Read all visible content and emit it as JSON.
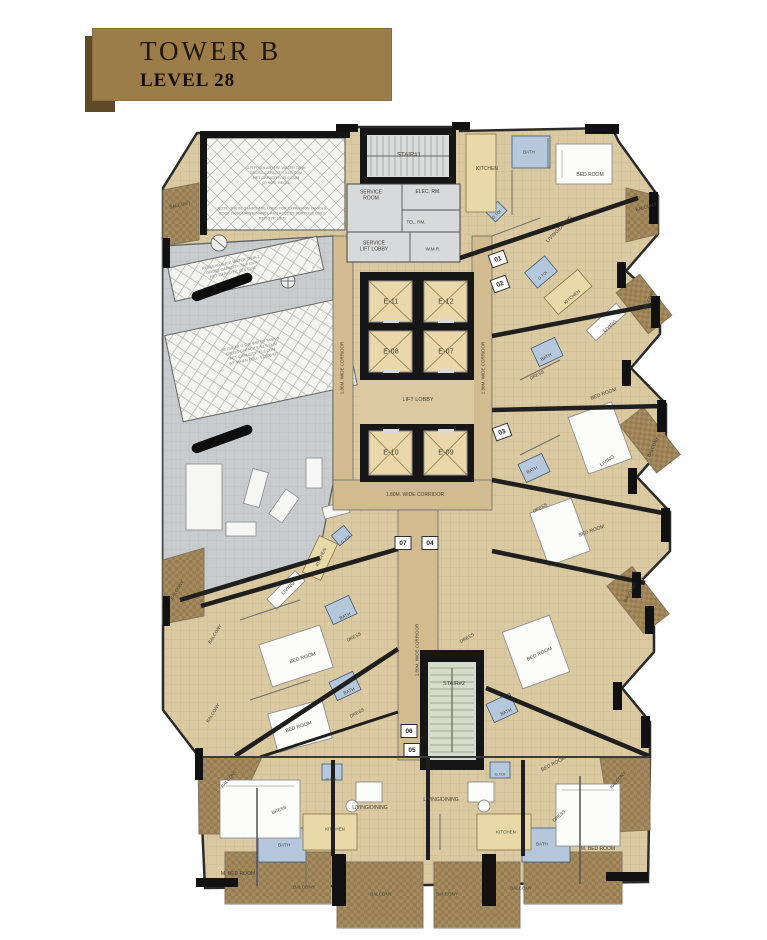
{
  "title": {
    "tower": "TOWER B",
    "level": "LEVEL 28"
  },
  "colors": {
    "banner": "#9c7d4a",
    "banner_shadow": "#5e4a26",
    "floor_tan": "#dbc9a1",
    "corridor_tan": "#d2bc8f",
    "wall_dark": "#161616",
    "mech_gray": "#c9ccce",
    "tank_hatch": "#f4f4f1",
    "balcony_brown": "#a78c60",
    "bath_blue": "#b5c7db",
    "stair_green": "#d5dcc9",
    "lift_cab": "#ead8ab"
  },
  "floor_plan": {
    "elevators": [
      {
        "id": "E-11",
        "x": 391,
        "y": 302
      },
      {
        "id": "E-12",
        "x": 446,
        "y": 302
      },
      {
        "id": "E-08",
        "x": 391,
        "y": 352
      },
      {
        "id": "E-07",
        "x": 446,
        "y": 352
      },
      {
        "id": "E-10",
        "x": 391,
        "y": 453
      },
      {
        "id": "E-09",
        "x": 446,
        "y": 453
      }
    ],
    "unit_badges": [
      {
        "n": "01",
        "x": 498,
        "y": 259,
        "r": -20
      },
      {
        "n": "02",
        "x": 500,
        "y": 284,
        "r": -20
      },
      {
        "n": "03",
        "x": 502,
        "y": 432,
        "r": -20
      },
      {
        "n": "07",
        "x": 403,
        "y": 543,
        "r": 0
      },
      {
        "n": "04",
        "x": 430,
        "y": 543,
        "r": 0
      },
      {
        "n": "06",
        "x": 409,
        "y": 731,
        "r": 0
      },
      {
        "n": "05",
        "x": 412,
        "y": 750,
        "r": 0
      }
    ],
    "labels": [
      {
        "t": "STAIR#1",
        "x": 409,
        "y": 156,
        "s": 6,
        "key": "stair1-label"
      },
      {
        "t": "SERVICE\nROOM",
        "x": 371,
        "y": 196,
        "s": 5,
        "key": "service-room-label"
      },
      {
        "t": "ELEC. RM.",
        "x": 428,
        "y": 193,
        "s": 5,
        "key": "elec-room-label"
      },
      {
        "t": "TEL. RM.",
        "x": 416,
        "y": 222,
        "s": 4.5,
        "key": "tel-room-label"
      },
      {
        "t": "SERVICE\nLIFT LOBBY",
        "x": 374,
        "y": 247,
        "s": 5,
        "key": "service-lift-lobby-label"
      },
      {
        "t": "W.M.R.",
        "x": 433,
        "y": 249,
        "s": 4.5,
        "key": "wmr-label"
      },
      {
        "t": "LIFT LOBBY",
        "x": 418,
        "y": 400,
        "s": 5.5,
        "key": "lift-lobby-label"
      },
      {
        "t": "1.80M. WIDE CORRIDOR",
        "x": 415,
        "y": 496,
        "s": 5,
        "key": "corridor-label-bottom"
      },
      {
        "t": "1.80M. WIDE CORRIDOR",
        "x": 342,
        "y": 368,
        "r": -90,
        "s": 4.5,
        "key": "corridor-label-left"
      },
      {
        "t": "1.80M. WIDE CORRIDOR",
        "x": 483,
        "y": 368,
        "r": -90,
        "s": 4.5,
        "key": "corridor-label-right"
      },
      {
        "t": "1.80M. WIDE CORRIDOR",
        "x": 417,
        "y": 650,
        "r": -90,
        "s": 4.5,
        "key": "corridor-label-mid"
      },
      {
        "t": "STAIR#2",
        "x": 454,
        "y": 684,
        "s": 5.5,
        "key": "stair2-label"
      },
      {
        "t": "KITCHEN",
        "x": 487,
        "y": 170,
        "s": 5
      },
      {
        "t": "BATH",
        "x": 529,
        "y": 152,
        "s": 4.5
      },
      {
        "t": "BED ROOM",
        "x": 590,
        "y": 176,
        "s": 5
      },
      {
        "t": "BALCONY",
        "x": 646,
        "y": 207,
        "r": -15,
        "s": 4.5
      },
      {
        "t": "LIVING/DINING",
        "x": 560,
        "y": 230,
        "r": -46,
        "s": 5
      },
      {
        "t": "G.TOI",
        "x": 497,
        "y": 215,
        "r": -45,
        "s": 4
      },
      {
        "t": "G.TOI",
        "x": 543,
        "y": 276,
        "r": -40,
        "s": 4
      },
      {
        "t": "KITCHEN",
        "x": 572,
        "y": 297,
        "r": -40,
        "s": 4.5
      },
      {
        "t": "LIVING",
        "x": 611,
        "y": 327,
        "r": -42,
        "s": 5
      },
      {
        "t": "BATH",
        "x": 546,
        "y": 357,
        "r": -28,
        "s": 4.5
      },
      {
        "t": "DRESS",
        "x": 537,
        "y": 375,
        "r": -28,
        "s": 4.5
      },
      {
        "t": "BED ROOM",
        "x": 604,
        "y": 395,
        "r": -20,
        "s": 5
      },
      {
        "t": "BALCONY",
        "x": 649,
        "y": 300,
        "r": -65,
        "s": 4.5
      },
      {
        "t": "BATH",
        "x": 532,
        "y": 470,
        "r": -25,
        "s": 4.5
      },
      {
        "t": "LIVING",
        "x": 608,
        "y": 462,
        "r": -35,
        "s": 5
      },
      {
        "t": "DRESS",
        "x": 540,
        "y": 508,
        "r": -28,
        "s": 4.5
      },
      {
        "t": "BED ROOM",
        "x": 592,
        "y": 532,
        "r": -20,
        "s": 5
      },
      {
        "t": "BALCONY",
        "x": 653,
        "y": 447,
        "r": -65,
        "s": 4.5
      },
      {
        "t": "DRESS",
        "x": 467,
        "y": 638,
        "r": -30,
        "s": 4.5
      },
      {
        "t": "BED ROOM",
        "x": 540,
        "y": 655,
        "r": -25,
        "s": 5
      },
      {
        "t": "BATH",
        "x": 506,
        "y": 712,
        "r": -25,
        "s": 4.5
      },
      {
        "t": "BALCONY",
        "x": 630,
        "y": 593,
        "r": -60,
        "s": 4.5
      },
      {
        "t": "G.TOI",
        "x": 346,
        "y": 540,
        "r": -40,
        "s": 4
      },
      {
        "t": "KITCHEN",
        "x": 321,
        "y": 557,
        "r": -65,
        "s": 4.5
      },
      {
        "t": "LIVING",
        "x": 289,
        "y": 589,
        "r": -45,
        "s": 5
      },
      {
        "t": "BATH",
        "x": 345,
        "y": 616,
        "r": -25,
        "s": 4.5
      },
      {
        "t": "DRESS",
        "x": 354,
        "y": 637,
        "r": -28,
        "s": 4.5
      },
      {
        "t": "BED ROOM",
        "x": 303,
        "y": 659,
        "r": -18,
        "s": 5
      },
      {
        "t": "BALCONY",
        "x": 215,
        "y": 634,
        "r": -58,
        "s": 4.5
      },
      {
        "t": "BATH",
        "x": 349,
        "y": 691,
        "r": -25,
        "s": 4.5
      },
      {
        "t": "DRESS",
        "x": 357,
        "y": 713,
        "r": -28,
        "s": 4.5
      },
      {
        "t": "BED ROOM",
        "x": 299,
        "y": 728,
        "r": -18,
        "s": 5
      },
      {
        "t": "BALCONY",
        "x": 213,
        "y": 713,
        "r": -58,
        "s": 4.5
      },
      {
        "t": "BALCONY",
        "x": 229,
        "y": 779,
        "r": -48,
        "s": 4.5
      },
      {
        "t": "DRESS",
        "x": 279,
        "y": 810,
        "r": -22,
        "s": 4.5
      },
      {
        "t": "G.TOI",
        "x": 331,
        "y": 780,
        "s": 4
      },
      {
        "t": "LIVING/DINING",
        "x": 370,
        "y": 809,
        "s": 5
      },
      {
        "t": "KITCHEN",
        "x": 335,
        "y": 829,
        "s": 4.5
      },
      {
        "t": "BATH",
        "x": 284,
        "y": 845,
        "s": 4.5
      },
      {
        "t": "M. BED ROOM",
        "x": 238,
        "y": 875,
        "s": 5
      },
      {
        "t": "BALCONY",
        "x": 304,
        "y": 887,
        "s": 4.5
      },
      {
        "t": "BALCONY",
        "x": 381,
        "y": 894,
        "s": 4.5
      },
      {
        "t": "LIVING/DINING",
        "x": 441,
        "y": 801,
        "s": 5
      },
      {
        "t": "G.TOI",
        "x": 500,
        "y": 775,
        "s": 4
      },
      {
        "t": "BED ROOM",
        "x": 554,
        "y": 765,
        "r": -28,
        "s": 5
      },
      {
        "t": "DRESS",
        "x": 559,
        "y": 816,
        "r": -40,
        "s": 4.5
      },
      {
        "t": "KITCHEN",
        "x": 506,
        "y": 832,
        "s": 4.5
      },
      {
        "t": "BATH",
        "x": 542,
        "y": 844,
        "s": 4.5
      },
      {
        "t": "M. BED ROOM",
        "x": 598,
        "y": 850,
        "s": 5
      },
      {
        "t": "BALCONY",
        "x": 521,
        "y": 888,
        "s": 4.5
      },
      {
        "t": "BALCONY",
        "x": 447,
        "y": 894,
        "s": 4.5
      },
      {
        "t": "BALCONY",
        "x": 618,
        "y": 780,
        "r": -48,
        "s": 4.5
      },
      {
        "t": "BALCONY",
        "x": 180,
        "y": 205,
        "r": -12,
        "s": 4.5
      },
      {
        "t": "BALCONY",
        "x": 177,
        "y": 590,
        "r": -58,
        "s": 4.5
      }
    ],
    "tank_notes": [
      {
        "t": "G.R.P. SOLAR H.W. WATER TANK\nGROSS CAPACITY: 51.0 CUM\nNET CAPACITY: 45.6 CUM\n(2) NOS. REQD.",
        "x": 276,
        "y": 176,
        "r": 0
      },
      {
        "t": "NOTE: THESE STAIRS ARE USED FOR EXPANSION TANKS &\nROOF TANK MAINTENANCE AND ACCESS PURPOSE ONLY\nREF. TYP. DET.",
        "x": 272,
        "y": 214,
        "r": 0
      },
      {
        "t": "REGULAR G.R.P. WATER TANK-2\nGROSS CAPACITY: 51.0 CUM\nNET CAPACITY: 45.6 CUM",
        "x": 232,
        "y": 268,
        "r": -12
      },
      {
        "t": "REGULAR G.R.P. WATER TANK-3\nGROSS CAPACITY: 51.0 CUM\nNET CAPACITY: 45.6 CUM\nWT. WHEN FULL: 51,000 KG",
        "x": 252,
        "y": 352,
        "r": -12
      }
    ]
  }
}
